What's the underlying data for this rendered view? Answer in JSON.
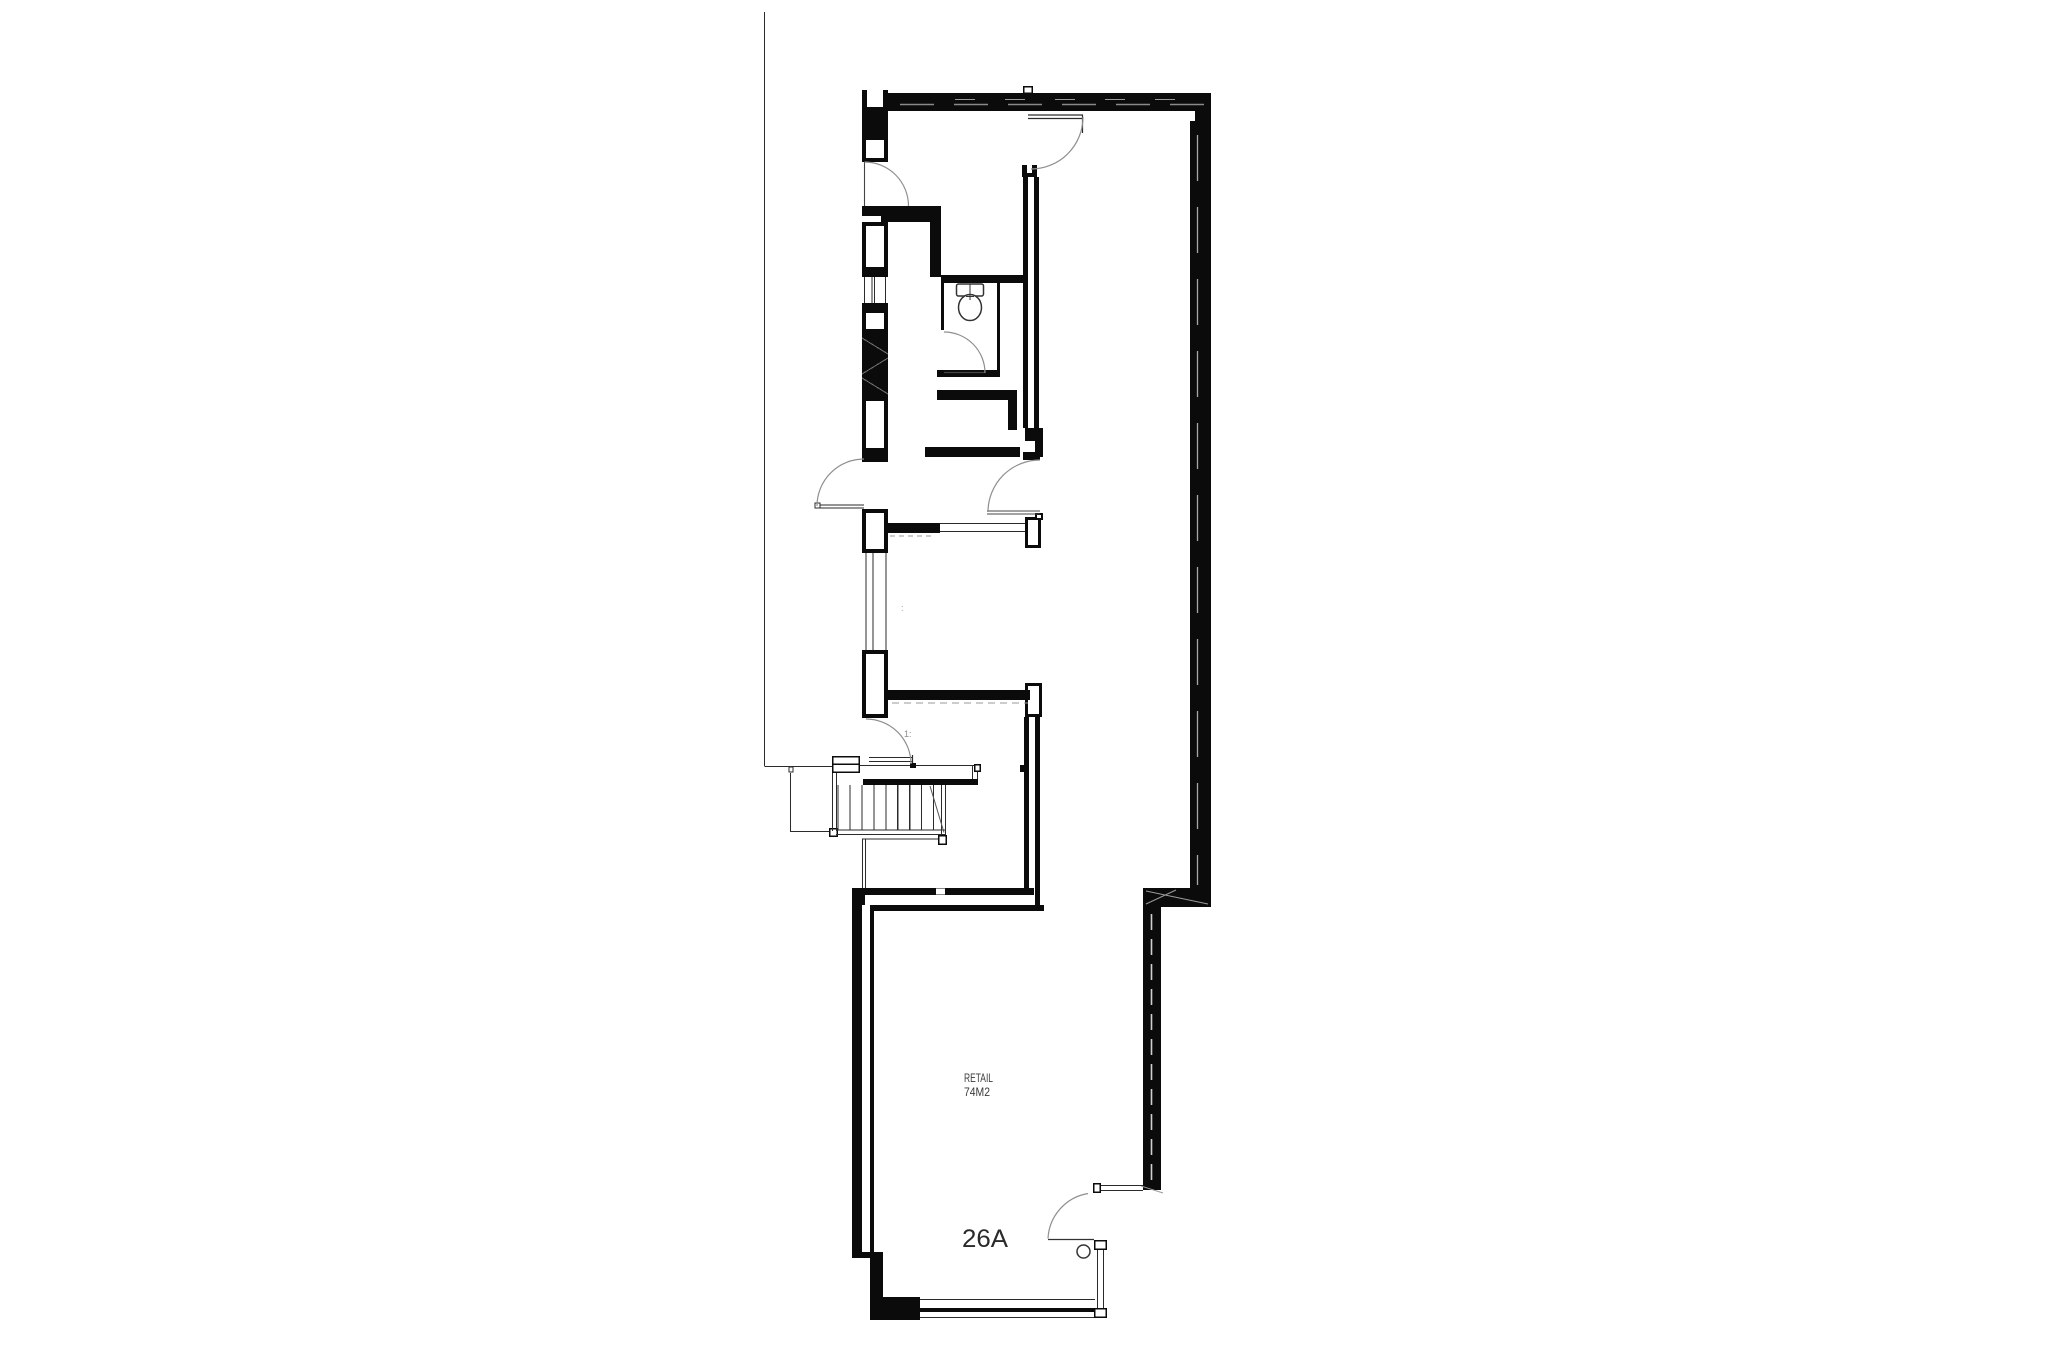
{
  "plan": {
    "unit_label": {
      "text": "26A"
    },
    "room": {
      "name": "RETAIL",
      "area": "74M2"
    },
    "stair_note": {
      "text": "1:"
    },
    "mid_note": {
      "text": ":"
    },
    "colors": {
      "wall": "#0b0b0b",
      "thin_line": "#2b2b2b",
      "arc": "#8f8f8f",
      "hatch": "#999999",
      "background": "#ffffff"
    }
  }
}
